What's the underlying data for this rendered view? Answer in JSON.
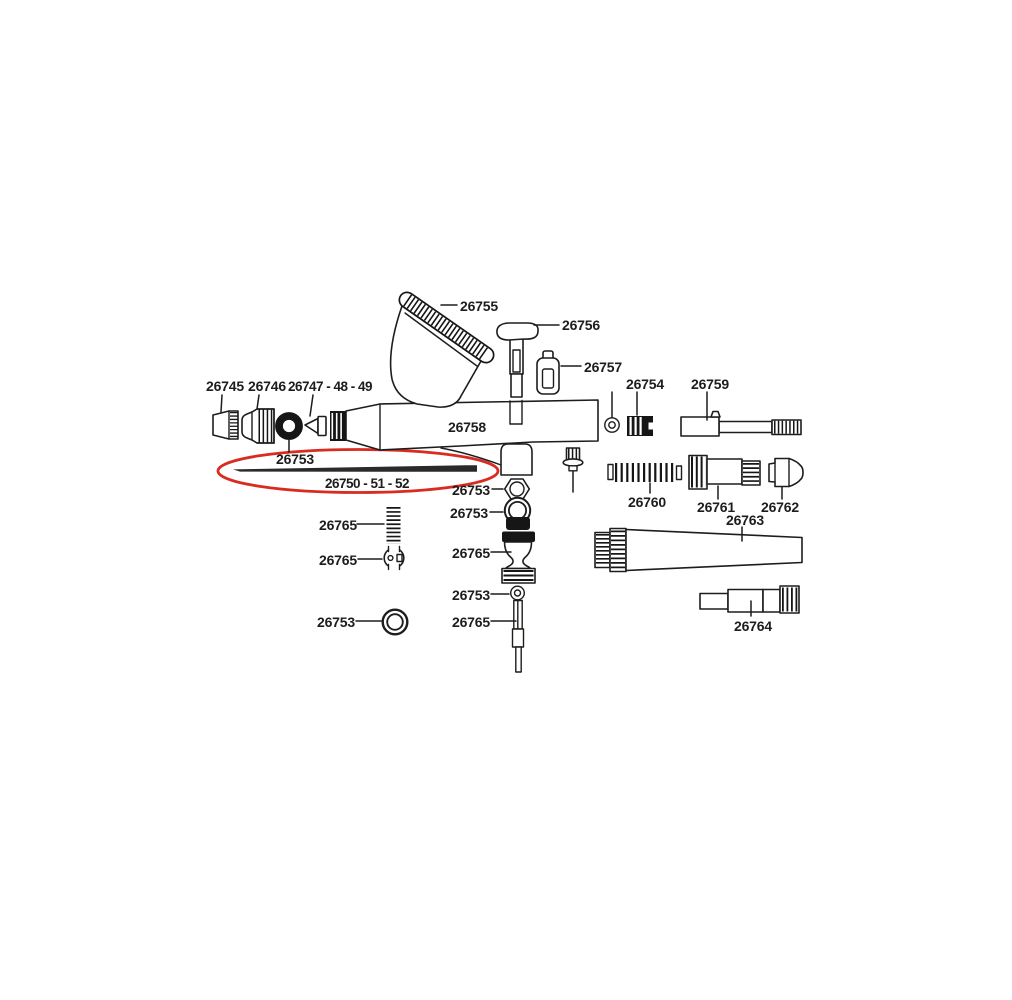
{
  "colors": {
    "background": "#ffffff",
    "line": "#1d1d1b",
    "highlight": "#d92b20"
  },
  "parts": {
    "p26745": "26745",
    "p26746": "26746",
    "p26747_48_49": "26747 - 48 - 49",
    "p26750_51_52": "26750 - 51 - 52",
    "p26753": "26753",
    "p26754": "26754",
    "p26755": "26755",
    "p26756": "26756",
    "p26757": "26757",
    "p26758": "26758",
    "p26759": "26759",
    "p26760": "26760",
    "p26761": "26761",
    "p26762": "26762",
    "p26763": "26763",
    "p26764": "26764",
    "p26765": "26765"
  }
}
